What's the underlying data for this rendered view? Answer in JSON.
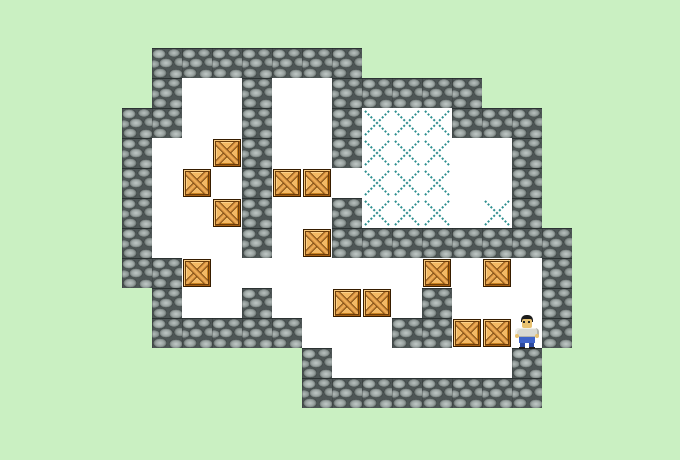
{
  "scene": {
    "description": "Sokoban puzzle level in progress",
    "background_color": "#caf0c2"
  },
  "board": {
    "tile_size": 30,
    "origin": {
      "x": 122,
      "y": 48
    },
    "cols": 15,
    "rows": 12,
    "legend": {
      "#": "wall",
      ".": "floor",
      "*": "goal",
      "B": "crate",
      "P": "player",
      " ": "outside"
    },
    "map": [
      " #######       ",
      " #..#..#####   ",
      "##..#..#***### ",
      "#..B#..#***..# ",
      "#.B.#BB.***..# ",
      "#..B#..#***.*# ",
      "#...#.B########",
      "##B.......B.B.#",
      " #..#..BB.#...#",
      " #####...##BBP#",
      "      #......# ",
      "      ######## "
    ],
    "counts": {
      "crates": 13,
      "goals": 13
    }
  },
  "entities": {
    "player_col_row": [
      13,
      9
    ],
    "crates_col_row": [
      [
        3,
        3
      ],
      [
        2,
        4
      ],
      [
        5,
        4
      ],
      [
        6,
        4
      ],
      [
        3,
        5
      ],
      [
        6,
        6
      ],
      [
        2,
        7
      ],
      [
        10,
        7
      ],
      [
        12,
        7
      ],
      [
        7,
        8
      ],
      [
        8,
        8
      ],
      [
        11,
        9
      ],
      [
        12,
        9
      ]
    ],
    "goals_col_row": [
      [
        8,
        2
      ],
      [
        9,
        2
      ],
      [
        10,
        2
      ],
      [
        8,
        3
      ],
      [
        9,
        3
      ],
      [
        10,
        3
      ],
      [
        8,
        4
      ],
      [
        9,
        4
      ],
      [
        10,
        4
      ],
      [
        8,
        5
      ],
      [
        9,
        5
      ],
      [
        10,
        5
      ],
      [
        12,
        5
      ]
    ]
  },
  "colors": {
    "bg": "#caf0c2",
    "floor": "#ffffff",
    "goal": "#2e8f8f",
    "wall_stone": "#9aa3a1",
    "crate_base": "#e79b3d",
    "crate_light": "#f3b964",
    "player_hair": "#1c1c1c",
    "player_skin": "#e9c271",
    "player_shirt": "#d9d9d1",
    "player_pants": "#3f64c9"
  }
}
